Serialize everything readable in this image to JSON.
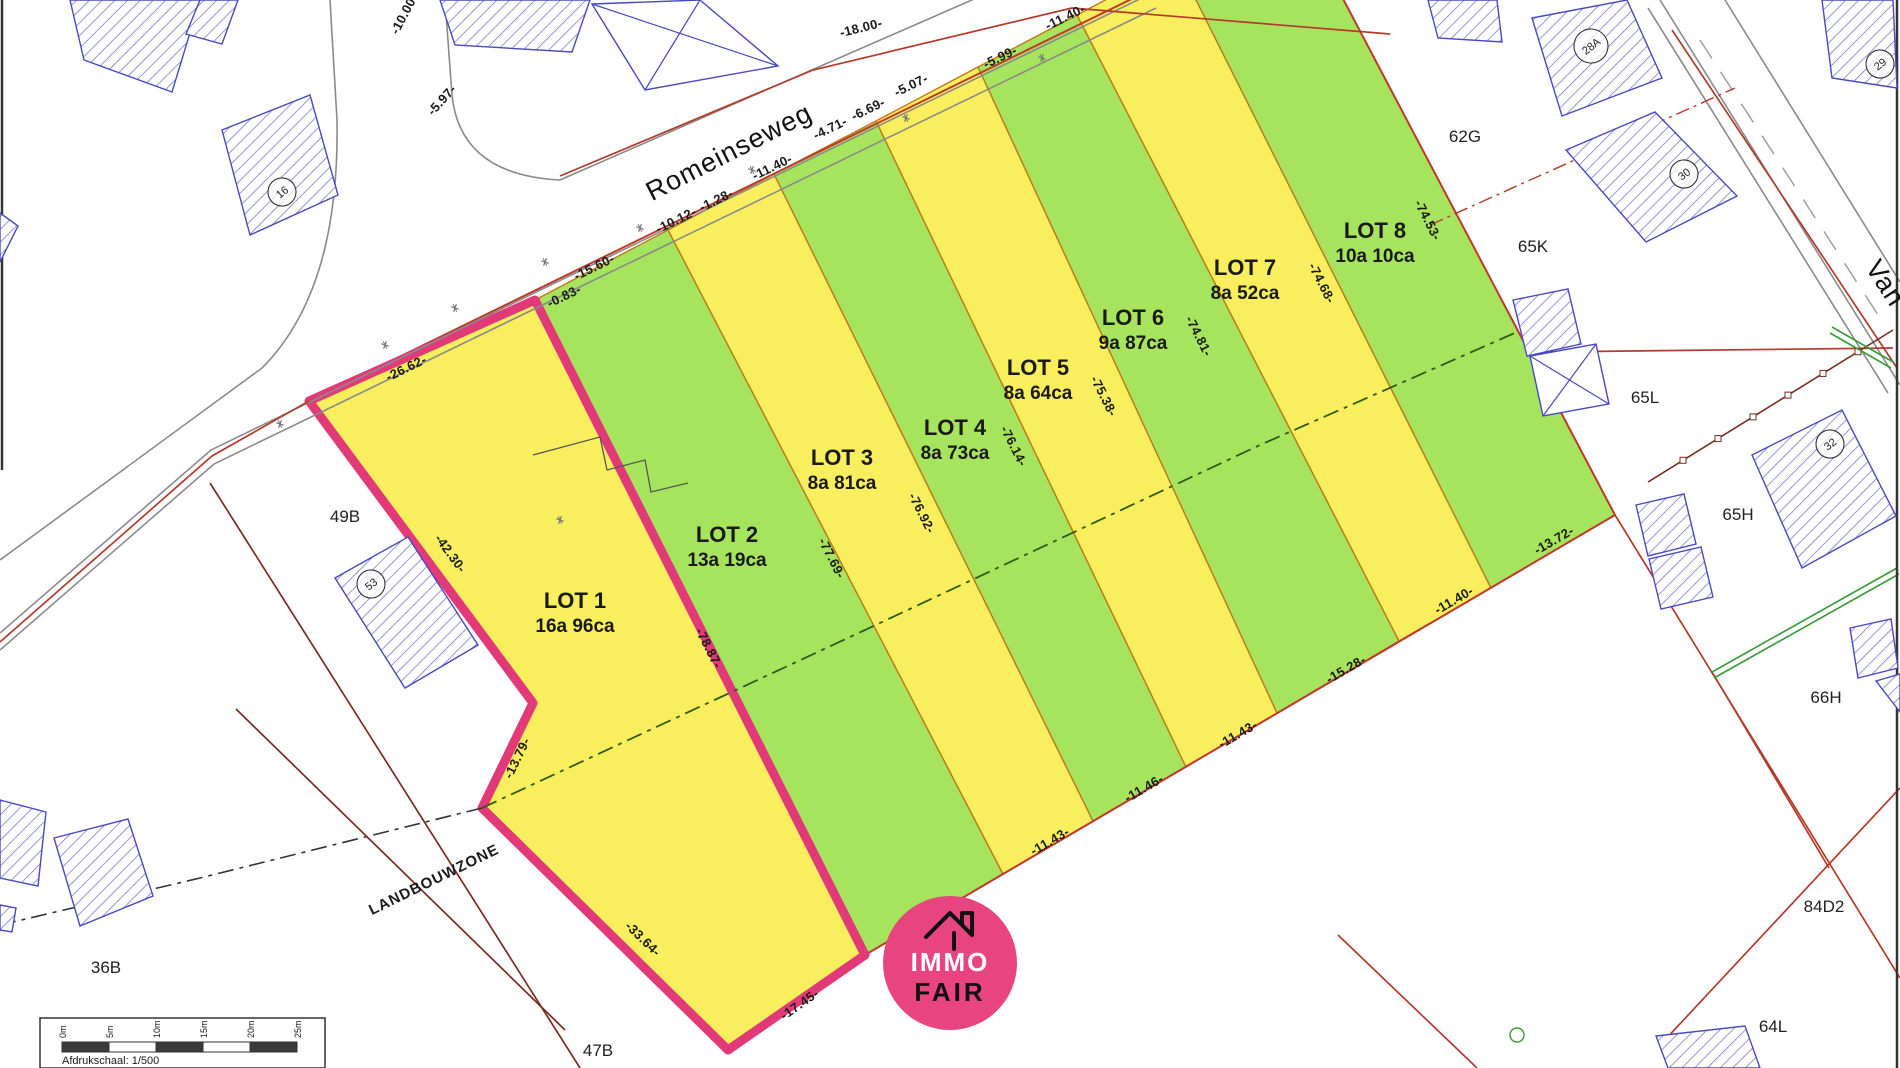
{
  "map": {
    "title": "verkavelingsplan",
    "colors": {
      "yellow": "#f9ef5e",
      "green": "#a7e45e",
      "lot_stroke": "#c07818",
      "highlight": "#e23a78",
      "red": "#c0392b",
      "darkred": "#7a2c20",
      "blue": "#4949c0",
      "grey": "#8a8a8a",
      "greenline": "#3a9a3a",
      "zoneline": "#2f5a18",
      "black": "#333333",
      "logo_pink": "#e8447e"
    },
    "road_label": {
      "text": "Romeinseweg",
      "x": 733,
      "y": 160,
      "rot": -27
    },
    "side_street_label": {
      "text": "Van",
      "x": 1878,
      "y": 288,
      "rot": 57
    },
    "zone_label": {
      "text": "LANDBOUWZONE",
      "x": 436,
      "y": 884,
      "rot": -26
    },
    "lots": [
      {
        "id": "lot-1",
        "name": "LOT 1",
        "area": "16a 96ca",
        "fill": "yellow",
        "highlighted": true,
        "points": "309,401 535,300 865,955 728,1050 482,808 533,703",
        "label": {
          "x": 575,
          "y": 608
        }
      },
      {
        "id": "lot-2",
        "name": "LOT 2",
        "area": "13a 19ca",
        "fill": "green",
        "highlighted": false,
        "points": "535,300 668,230 1003,874 865,955",
        "label": {
          "x": 727,
          "y": 542
        }
      },
      {
        "id": "lot-3",
        "name": "LOT 3",
        "area": "8a 81ca",
        "fill": "yellow",
        "highlighted": false,
        "points": "668,230 774,174 1093,821 1003,874",
        "label": {
          "x": 842,
          "y": 465
        }
      },
      {
        "id": "lot-4",
        "name": "LOT 4",
        "area": "8a 73ca",
        "fill": "green",
        "highlighted": false,
        "points": "774,174 876,121 1186,767 1093,821",
        "label": {
          "x": 955,
          "y": 435
        }
      },
      {
        "id": "lot-5",
        "name": "LOT 5",
        "area": "8a 64ca",
        "fill": "yellow",
        "highlighted": false,
        "points": "876,121 978,67 1277,713 1186,767",
        "label": {
          "x": 1038,
          "y": 375
        }
      },
      {
        "id": "lot-6",
        "name": "LOT 6",
        "area": "9a 87ca",
        "fill": "green",
        "highlighted": false,
        "points": "978,67 1077,15 1399,641 1277,713",
        "label": {
          "x": 1133,
          "y": 325
        }
      },
      {
        "id": "lot-7",
        "name": "LOT 7",
        "area": "8a 52ca",
        "fill": "yellow",
        "highlighted": false,
        "points": "1077,15 1177,-38 1491,588 1399,641",
        "label": {
          "x": 1245,
          "y": 275
        }
      },
      {
        "id": "lot-8",
        "name": "LOT 8",
        "area": "10a 10ca",
        "fill": "green",
        "highlighted": false,
        "points": "1177,-38 1292,-98 1615,515 1491,588",
        "label": {
          "x": 1375,
          "y": 238
        }
      }
    ],
    "measurements": [
      {
        "text": "-10.00-",
        "x": 408,
        "y": 16,
        "rot": -62
      },
      {
        "text": "-5.97-",
        "x": 445,
        "y": 103,
        "rot": -48
      },
      {
        "text": "-26.62-",
        "x": 408,
        "y": 372,
        "rot": -26
      },
      {
        "text": "-0.83-",
        "x": 566,
        "y": 300,
        "rot": -26
      },
      {
        "text": "-15.60-",
        "x": 596,
        "y": 271,
        "rot": -26
      },
      {
        "text": "-10.12-",
        "x": 678,
        "y": 224,
        "rot": -26
      },
      {
        "text": "-1.28-",
        "x": 718,
        "y": 204,
        "rot": -26
      },
      {
        "text": "-11.40-",
        "x": 774,
        "y": 171,
        "rot": -26
      },
      {
        "text": "-4.71-",
        "x": 832,
        "y": 132,
        "rot": -26
      },
      {
        "text": "-6.69-",
        "x": 870,
        "y": 113,
        "rot": -26
      },
      {
        "text": "-5.07-",
        "x": 913,
        "y": 89,
        "rot": -26
      },
      {
        "text": "-5.99-",
        "x": 1002,
        "y": 61,
        "rot": -26
      },
      {
        "text": "-11.40-",
        "x": 1067,
        "y": 21,
        "rot": -26
      },
      {
        "text": "-18.00-",
        "x": 862,
        "y": 32,
        "rot": -14
      },
      {
        "text": "-42.30-",
        "x": 447,
        "y": 556,
        "rot": 54
      },
      {
        "text": "-13.79-",
        "x": 521,
        "y": 760,
        "rot": -64
      },
      {
        "text": "-33.64-",
        "x": 640,
        "y": 942,
        "rot": 44
      },
      {
        "text": "-17.45-",
        "x": 802,
        "y": 1008,
        "rot": -35
      },
      {
        "text": "-78.87-",
        "x": 705,
        "y": 650,
        "rot": 63
      },
      {
        "text": "-77.69-",
        "x": 828,
        "y": 560,
        "rot": 63
      },
      {
        "text": "-76.92-",
        "x": 918,
        "y": 515,
        "rot": 63
      },
      {
        "text": "-76.14-",
        "x": 1010,
        "y": 448,
        "rot": 63
      },
      {
        "text": "-75.38-",
        "x": 1100,
        "y": 398,
        "rot": 63
      },
      {
        "text": "-74.81-",
        "x": 1195,
        "y": 338,
        "rot": 63
      },
      {
        "text": "-74.68-",
        "x": 1318,
        "y": 285,
        "rot": 63
      },
      {
        "text": "-74.53-",
        "x": 1424,
        "y": 222,
        "rot": 63
      },
      {
        "text": "-11.43-",
        "x": 1052,
        "y": 845,
        "rot": -30
      },
      {
        "text": "-11.46-",
        "x": 1146,
        "y": 792,
        "rot": -30
      },
      {
        "text": "-11.43-",
        "x": 1240,
        "y": 738,
        "rot": -30
      },
      {
        "text": "-15.28-",
        "x": 1348,
        "y": 673,
        "rot": -30
      },
      {
        "text": "-11.40-",
        "x": 1456,
        "y": 604,
        "rot": -30
      },
      {
        "text": "-13.72-",
        "x": 1556,
        "y": 544,
        "rot": -30
      }
    ],
    "parcel_labels": [
      {
        "text": "49B",
        "x": 345,
        "y": 522
      },
      {
        "text": "62G",
        "x": 1465,
        "y": 142
      },
      {
        "text": "65K",
        "x": 1533,
        "y": 252
      },
      {
        "text": "65L",
        "x": 1645,
        "y": 403
      },
      {
        "text": "65H",
        "x": 1738,
        "y": 520
      },
      {
        "text": "66H",
        "x": 1826,
        "y": 703
      },
      {
        "text": "36B",
        "x": 106,
        "y": 973
      },
      {
        "text": "47B",
        "x": 598,
        "y": 1056
      },
      {
        "text": "84D2",
        "x": 1824,
        "y": 912
      },
      {
        "text": "64L",
        "x": 1773,
        "y": 1032
      }
    ],
    "building_labels": [
      {
        "text": "16",
        "x": 282,
        "y": 192,
        "rot": -38,
        "r": 14
      },
      {
        "text": "53",
        "x": 371,
        "y": 584,
        "rot": -38,
        "r": 14
      },
      {
        "text": "28A",
        "x": 1591,
        "y": 46,
        "rot": -38,
        "r": 17
      },
      {
        "text": "30",
        "x": 1684,
        "y": 174,
        "rot": -38,
        "r": 14
      },
      {
        "text": "29",
        "x": 1880,
        "y": 64,
        "rot": -38,
        "r": 14
      },
      {
        "text": "32",
        "x": 1830,
        "y": 444,
        "rot": -38,
        "r": 14
      }
    ],
    "buildings_hatched": [
      "70,0 200,0 172,92 84,60",
      "200,0 238,0 222,44 186,34",
      "440,0 590,0 572,52 455,45",
      "222,130 310,95 338,195 250,235",
      "0,213 18,226 0,262",
      "1428,0 1497,0 1502,42 1438,38",
      "1532,18 1627,0 1662,78 1562,116",
      "1822,0 1893,0 1897,88 1832,78",
      "1566,150 1655,112 1737,196 1646,242",
      "1752,455 1842,410 1896,516 1802,568",
      "1513,300 1568,289 1581,344 1527,356",
      "1636,505 1684,494 1696,544 1648,556",
      "1649,559 1701,547 1713,597 1661,609",
      "1850,628 1891,619 1898,668 1858,678",
      "1876,681 1900,674 1900,712",
      "335,578 408,537 478,645 405,688",
      "0,800 46,812 38,886 0,878",
      "54,838 128,819 153,896 80,926",
      "0,905 16,908 12,932 0,930",
      "1656,1036 1745,1026 1760,1068 1668,1068"
    ],
    "buildings_crossed": [
      "592,4 700,0 778,66 645,90",
      "1530,356 1596,344 1609,404 1543,416"
    ],
    "grey_lines": [
      "0,650 214,464 1156,8",
      "0,633 211,450 1150,-6",
      "0,560 262,368",
      "560,180 1084,-49",
      "1660,0 1900,385",
      "1648,8 1888,393",
      "1725,0 1900,282"
    ],
    "grey_paths": [
      "M330,0 L337,120 Q340,290 262,368",
      "M445,0 L452,95 Q460,175 560,180"
    ],
    "dashed_grey": [
      "1700,40 1880,318"
    ],
    "red_lines": [
      "0,642 212,456 309,401",
      "560,176 813,70 1072,8",
      "1072,8 1390,34",
      "1543,352 1893,348",
      "1615,515 1900,978",
      "1663,1042 1900,788",
      "1712,672 1829,868",
      "1338,935 1477,1068",
      "1672,30 1897,368",
      "309,401 1150,-10",
      "865,955 1615,515",
      "1292,-98 1615,515"
    ],
    "darkred_lines": [
      "210,483 580,1068",
      "236,709 565,1030"
    ],
    "dashdot_red": [
      "1430,225 1735,88"
    ],
    "ticked_line": {
      "points": "1648,482 1893,330",
      "ticks": 6
    },
    "green_lines": [
      "1712,672 1897,568",
      "1714,678 1899,574",
      "1832,327 1893,362",
      "1830,333 1891,368"
    ],
    "dashdot_zone": "482,808 850,637 1260,445 1517,332",
    "dashdot_landbouw": "0,925 200,878 482,808",
    "stepped_outline": "533,455 600,437 607,470 645,460 651,492 688,483",
    "road_symbols": [
      [
        385,
        345
      ],
      [
        455,
        308
      ],
      [
        545,
        262
      ],
      [
        640,
        228
      ],
      [
        752,
        170
      ],
      [
        906,
        118
      ],
      [
        1042,
        58
      ],
      [
        280,
        424
      ],
      [
        560,
        520
      ]
    ],
    "green_circle": {
      "x": 1517,
      "y": 1035,
      "r": 7
    },
    "frame_lines": [
      {
        "x1": 2,
        "y1": 0,
        "x2": 2,
        "y2": 470
      },
      {
        "x1": 1897,
        "y1": 0,
        "x2": 1897,
        "y2": 1068
      }
    ],
    "scalebar": {
      "x": 40,
      "y": 1018,
      "w": 285,
      "h": 50,
      "bar_x": 62,
      "bar_y": 1042,
      "seg_w": 47,
      "bar_h": 10,
      "ticks": [
        "0m",
        "5m",
        "10m",
        "15m",
        "20m",
        "25m"
      ],
      "caption": "Afdrukschaal: 1/500"
    },
    "logo": {
      "cx": 950,
      "cy": 963,
      "r": 67,
      "line1": "IMMO",
      "line2": "FAIR"
    }
  }
}
